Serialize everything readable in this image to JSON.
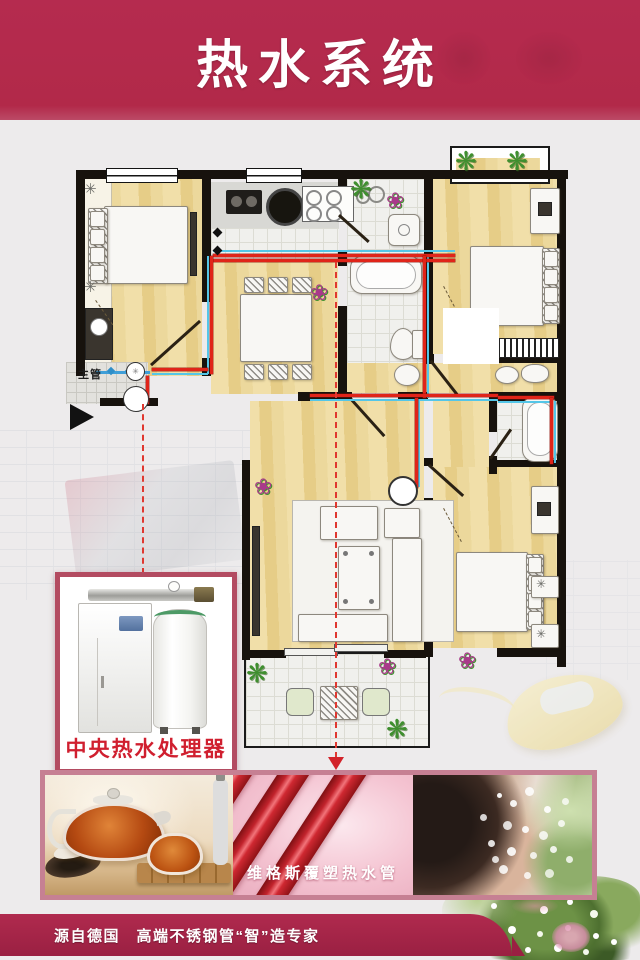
{
  "header": {
    "title": "热水系统"
  },
  "floorplan": {
    "main_pipe_label": "主管",
    "legend": {
      "hot_pipe": "red",
      "cold_pipe": "cyan"
    }
  },
  "inset": {
    "caption": "中央热水处理器"
  },
  "strip": {
    "pipe_caption": "维格斯覆塑热水管",
    "photos": [
      "tea-set-photo",
      "coated-pipes-photo",
      "face-washing-photo"
    ]
  },
  "footer": {
    "text": "源自德国　高端不锈钢管“智”造专家"
  },
  "colors": {
    "header_bg": "#b42a4e",
    "footer_bg": "#9a2042",
    "hot_pipe": "#e02419",
    "cold_pipe": "#54c6e8",
    "inset_border": "#b34b61",
    "strip_border": "#c68093",
    "caption_red": "#d01f2f"
  },
  "icons": {
    "plant": "❋",
    "flower": "❀",
    "fan": "✳"
  }
}
